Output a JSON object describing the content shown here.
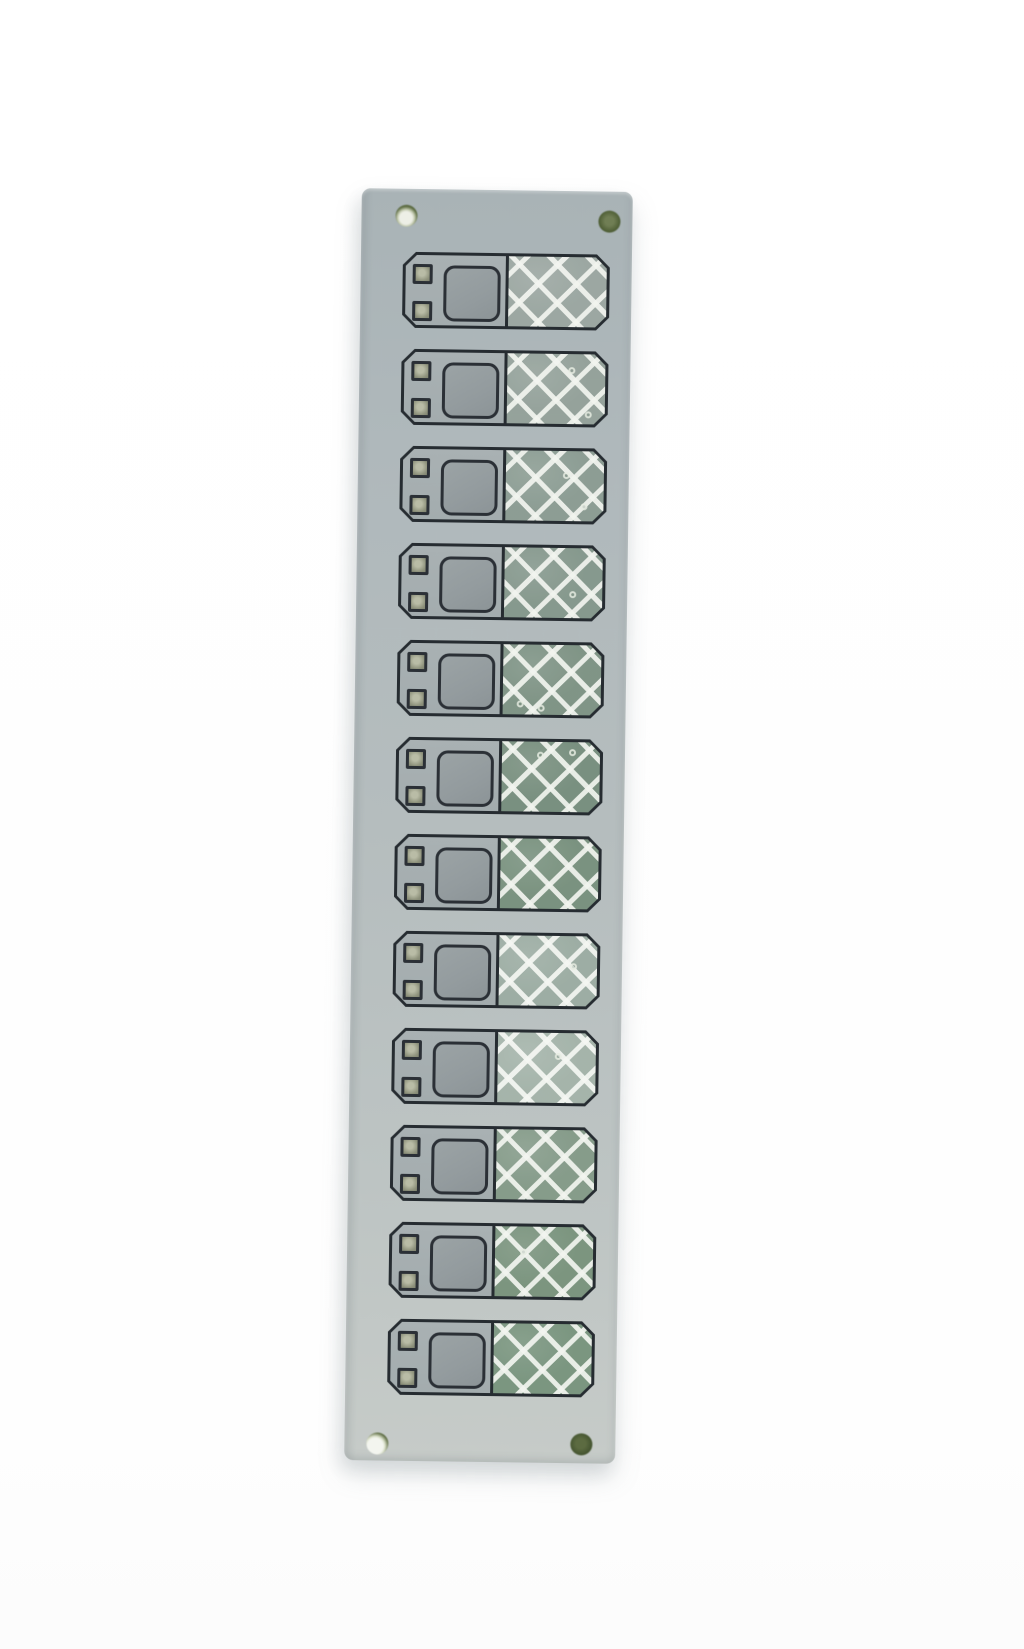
{
  "scene": {
    "type": "photograph",
    "subject": "vertical ceramic PCB substrate panel strip with twelve identical printed circuit units",
    "background_color": "#ffffff"
  },
  "panel": {
    "material_look": "light blue-gray ceramic",
    "color_top": "#a9b3b6",
    "color_bottom": "#c6cbc8",
    "outline_color": "#262c31",
    "rotation_deg": 0.8,
    "unit_count": 12,
    "mounting_holes": [
      {
        "position": "top-left",
        "appearance": "light center with dark olive rim"
      },
      {
        "position": "top-right",
        "appearance": "solid dark olive-green"
      },
      {
        "position": "bottom-left",
        "appearance": "bright highlight with dark upper crescent"
      },
      {
        "position": "bottom-right",
        "appearance": "solid dark olive-green"
      }
    ]
  },
  "unit_template": {
    "left_region_fill": "#a6aeb0",
    "outline_color": "#262c31",
    "large_pad": {
      "fill": "#939b9e",
      "border": "#2b3036",
      "corner": "rounded"
    },
    "small_pads": {
      "count": 2,
      "fill": "#8e927c",
      "border": "#2b3036"
    },
    "hatch_line_color": "#eef1ea",
    "hatch_diamond_pitch_px": 30
  },
  "units": [
    {
      "id": 1,
      "hatch_color": "#8e9b95",
      "white_wash": 0.12,
      "specks": []
    },
    {
      "id": 2,
      "hatch_color": "#899890",
      "white_wash": 0.1,
      "specks": [
        {
          "x": 62,
          "y": 18
        },
        {
          "x": 80,
          "y": 82
        }
      ]
    },
    {
      "id": 3,
      "hatch_color": "#83958b",
      "white_wash": 0.08,
      "specks": [
        {
          "x": 58,
          "y": 30
        },
        {
          "x": 77,
          "y": 74
        }
      ]
    },
    {
      "id": 4,
      "hatch_color": "#7d9185",
      "white_wash": 0.07,
      "specks": [
        {
          "x": 66,
          "y": 62
        }
      ]
    },
    {
      "id": 5,
      "hatch_color": "#788e7f",
      "white_wash": 0.06,
      "specks": [
        {
          "x": 14,
          "y": 80
        },
        {
          "x": 36,
          "y": 86
        }
      ]
    },
    {
      "id": 6,
      "hatch_color": "#728a79",
      "white_wash": 0.05,
      "specks": [
        {
          "x": 36,
          "y": 14
        },
        {
          "x": 68,
          "y": 10
        }
      ]
    },
    {
      "id": 7,
      "hatch_color": "#708a76",
      "white_wash": 0.07,
      "specks": []
    },
    {
      "id": 8,
      "hatch_color": "#7b9184",
      "white_wash": 0.26,
      "specks": [
        {
          "x": 72,
          "y": 38
        }
      ]
    },
    {
      "id": 9,
      "hatch_color": "#7e9486",
      "white_wash": 0.3,
      "specks": [
        {
          "x": 58,
          "y": 28
        }
      ]
    },
    {
      "id": 10,
      "hatch_color": "#748d79",
      "white_wash": 0.13,
      "specks": []
    },
    {
      "id": 11,
      "hatch_color": "#6d8971",
      "white_wash": 0.1,
      "specks": [
        {
          "x": 26,
          "y": 32
        }
      ]
    },
    {
      "id": 12,
      "hatch_color": "#6c8a72",
      "white_wash": 0.1,
      "specks": []
    }
  ]
}
